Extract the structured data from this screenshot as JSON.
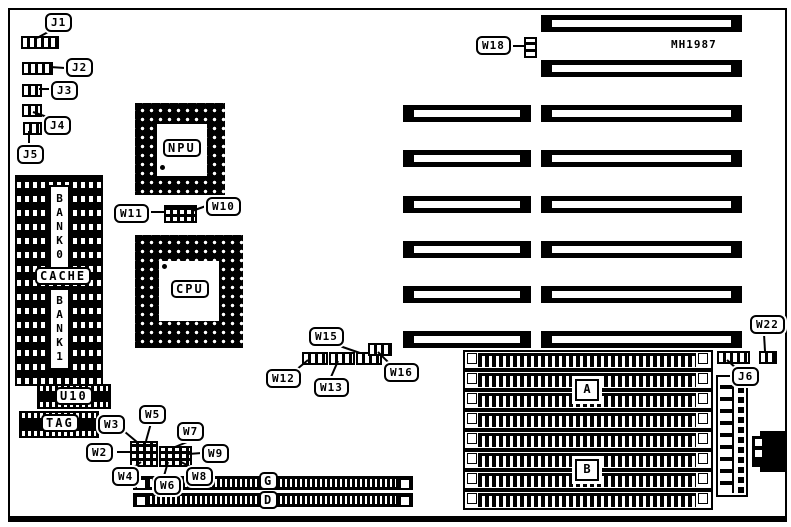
{
  "board": {
    "part_number": "MH1987"
  },
  "connectors": {
    "j1": "J1",
    "j2": "J2",
    "j3": "J3",
    "j4": "J4",
    "j5": "J5",
    "j6": "J6"
  },
  "jumpers": {
    "w2": "W2",
    "w3": "W3",
    "w4": "W4",
    "w5": "W5",
    "w6": "W6",
    "w7": "W7",
    "w8": "W8",
    "w9": "W9",
    "w10": "W10",
    "w11": "W11",
    "w12": "W12",
    "w13": "W13",
    "w15": "W15",
    "w16": "W16",
    "w18": "W18",
    "w22": "W22"
  },
  "chips": {
    "npu": "NPU",
    "cpu": "CPU",
    "u10": "U10",
    "tag": "TAG"
  },
  "cache": {
    "bank0": "BANK0",
    "label": "CACHE",
    "bank1": "BANK1"
  },
  "slots": {
    "g": "G",
    "d": "D"
  },
  "simm": {
    "bank_a": "A",
    "bank_b": "B"
  }
}
